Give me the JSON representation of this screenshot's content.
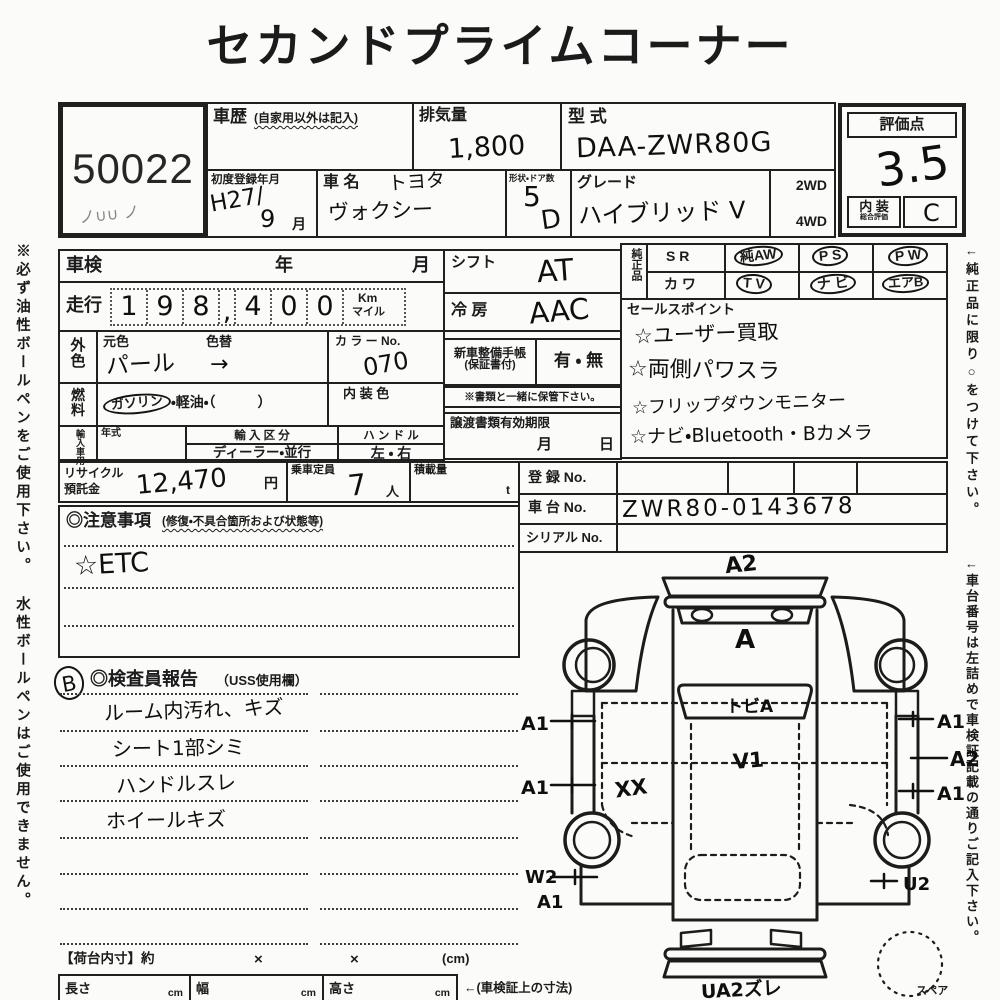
{
  "colors": {
    "ink": "#1b1b1b",
    "paper": "#fbfbf9"
  },
  "title": "セカンドプライムコーナー",
  "lot": {
    "number": "50022",
    "scribble": "ノ∪∪ ノ"
  },
  "header": {
    "shareki_label": "車歴",
    "shareki_note": "(自家用以外は記入)",
    "haiki_label": "排気量",
    "haiki_value": "1,800",
    "katashiki_label": "型 式",
    "katashiki_value": "DAA-ZWR80G",
    "first_reg_label": "初度登録年月",
    "first_reg_value": "H27/",
    "first_reg_value2": "9",
    "first_reg_month": "月",
    "name_label": "車 名",
    "maker_value": "トヨタ",
    "name_value": "ヴォクシー",
    "shape_label": "形状・ドア数",
    "shape_value": "5",
    "shape_value2": "D",
    "grade_label": "グレード",
    "grade_value": "ハイブリッド V",
    "drive_2wd": "2WD",
    "drive_4wd": "4WD"
  },
  "rating": {
    "label": "評価点",
    "score": "3.5",
    "interior_label": "内 装",
    "interior_sub": "総合評価",
    "interior_grade": "C"
  },
  "side_notes": {
    "left": "※必ず油性ボールペンをご使用下さい。 水性ボールペンはご使用できません。",
    "right1": "←純正品に限り○をつけて下さい。",
    "right2": "←車台番号は左詰めで車検証記載の通りご記入下さい。"
  },
  "spec": {
    "shaken_label": "車検",
    "year_label": "年",
    "month_label": "月",
    "mileage_label": "走行",
    "mileage_digits": [
      "1",
      "9",
      "8",
      ",",
      "4",
      "0",
      "0"
    ],
    "mileage_unit_top": "Km",
    "mileage_unit_bottom": "マイル",
    "ext_color_1": "外",
    "ext_color_2": "色",
    "base_color_label": "元色",
    "base_color_value": "パール",
    "repaint_label": "色替",
    "repaint_value": "→",
    "color_no_label": "カ ラ ー No.",
    "color_no_value": "070",
    "fuel_1": "燃",
    "fuel_2": "料",
    "fuel_circled": "ガソリン",
    "fuel_rest": "・軽油・（　　　）",
    "interior_color_label": "内 装 色",
    "import_label": "輸入車用",
    "year_model_label": "年式",
    "import_class_label": "輸 入 区 分",
    "import_class_options": "ディーラー・並行",
    "handle_label": "ハ ン ド ル",
    "handle_options": "左 ・ 右"
  },
  "shift": {
    "label": "シフト",
    "value": "AT"
  },
  "ac": {
    "label": "冷 房",
    "value": "AAC"
  },
  "warranty": {
    "label": "新車整備手帳",
    "sub": "(保証書付)",
    "options": "有 ・ 無",
    "note": "※書類と一緒に保管下さい。"
  },
  "transfer": {
    "label": "譲渡書類有効期限",
    "month": "月",
    "day": "日"
  },
  "genuine": {
    "label": "純正品",
    "row1": [
      {
        "t": "S R",
        "c": false
      },
      {
        "t": "純AW",
        "c": true
      },
      {
        "t": "P S",
        "c": true
      },
      {
        "t": "P W",
        "c": true
      }
    ],
    "row2": [
      {
        "t": "カ ワ",
        "c": false
      },
      {
        "t": "T V",
        "c": true
      },
      {
        "t": "ナ ビ",
        "c": true
      },
      {
        "t": "エアB",
        "c": true
      }
    ]
  },
  "sales": {
    "label": "セールスポイント",
    "items": [
      "☆ユーザー買取",
      "☆両側パワスラ",
      "☆フリップダウンモニター",
      "☆ナビ・Bluetooth・Bカメラ"
    ]
  },
  "recycle": {
    "label1": "リサイクル",
    "label2": "預託金",
    "value": "12,470",
    "unit": "円"
  },
  "capacity": {
    "label": "乗車定員",
    "value": "7",
    "unit": "人"
  },
  "payload": {
    "label": "積載量",
    "unit": "t"
  },
  "reg": {
    "reg_label": "登 録 No.",
    "chassis_label": "車 台 No.",
    "chassis_value": "ZWR80-0143678",
    "serial_label": "シリアル No."
  },
  "caution": {
    "label": "◎注意事項",
    "sub": "(修復・不具合箇所および状態等)",
    "entry": "☆ETC"
  },
  "inspector": {
    "mark": "B",
    "label": "◎検査員報告",
    "sub": "（USS使用欄）",
    "entries": [
      "ルーム内汚れ、キズ",
      "シート1部シミ",
      "ハンドルスレ",
      "ホイールキズ"
    ]
  },
  "diagram": {
    "marks": {
      "front_top": "A2",
      "hood": "A",
      "windshield": "トビA",
      "roof": "V1",
      "left_door": "XX",
      "left1": "A1",
      "left2": "A1",
      "right1": "A1",
      "right2": "A2",
      "right3": "A1",
      "rear_left1": "W2",
      "rear_left2": "A1",
      "rear_right": "U2",
      "rear_bumper": "UA2ズレ",
      "spare": "スペア"
    }
  },
  "cargo": {
    "label": "【荷台内寸】約",
    "x1": "×",
    "x2": "×",
    "unit": "(cm)",
    "len": "長さ",
    "wid": "幅",
    "hgt": "高さ",
    "cm": "cm",
    "note": "←(車検証上の寸法)"
  }
}
